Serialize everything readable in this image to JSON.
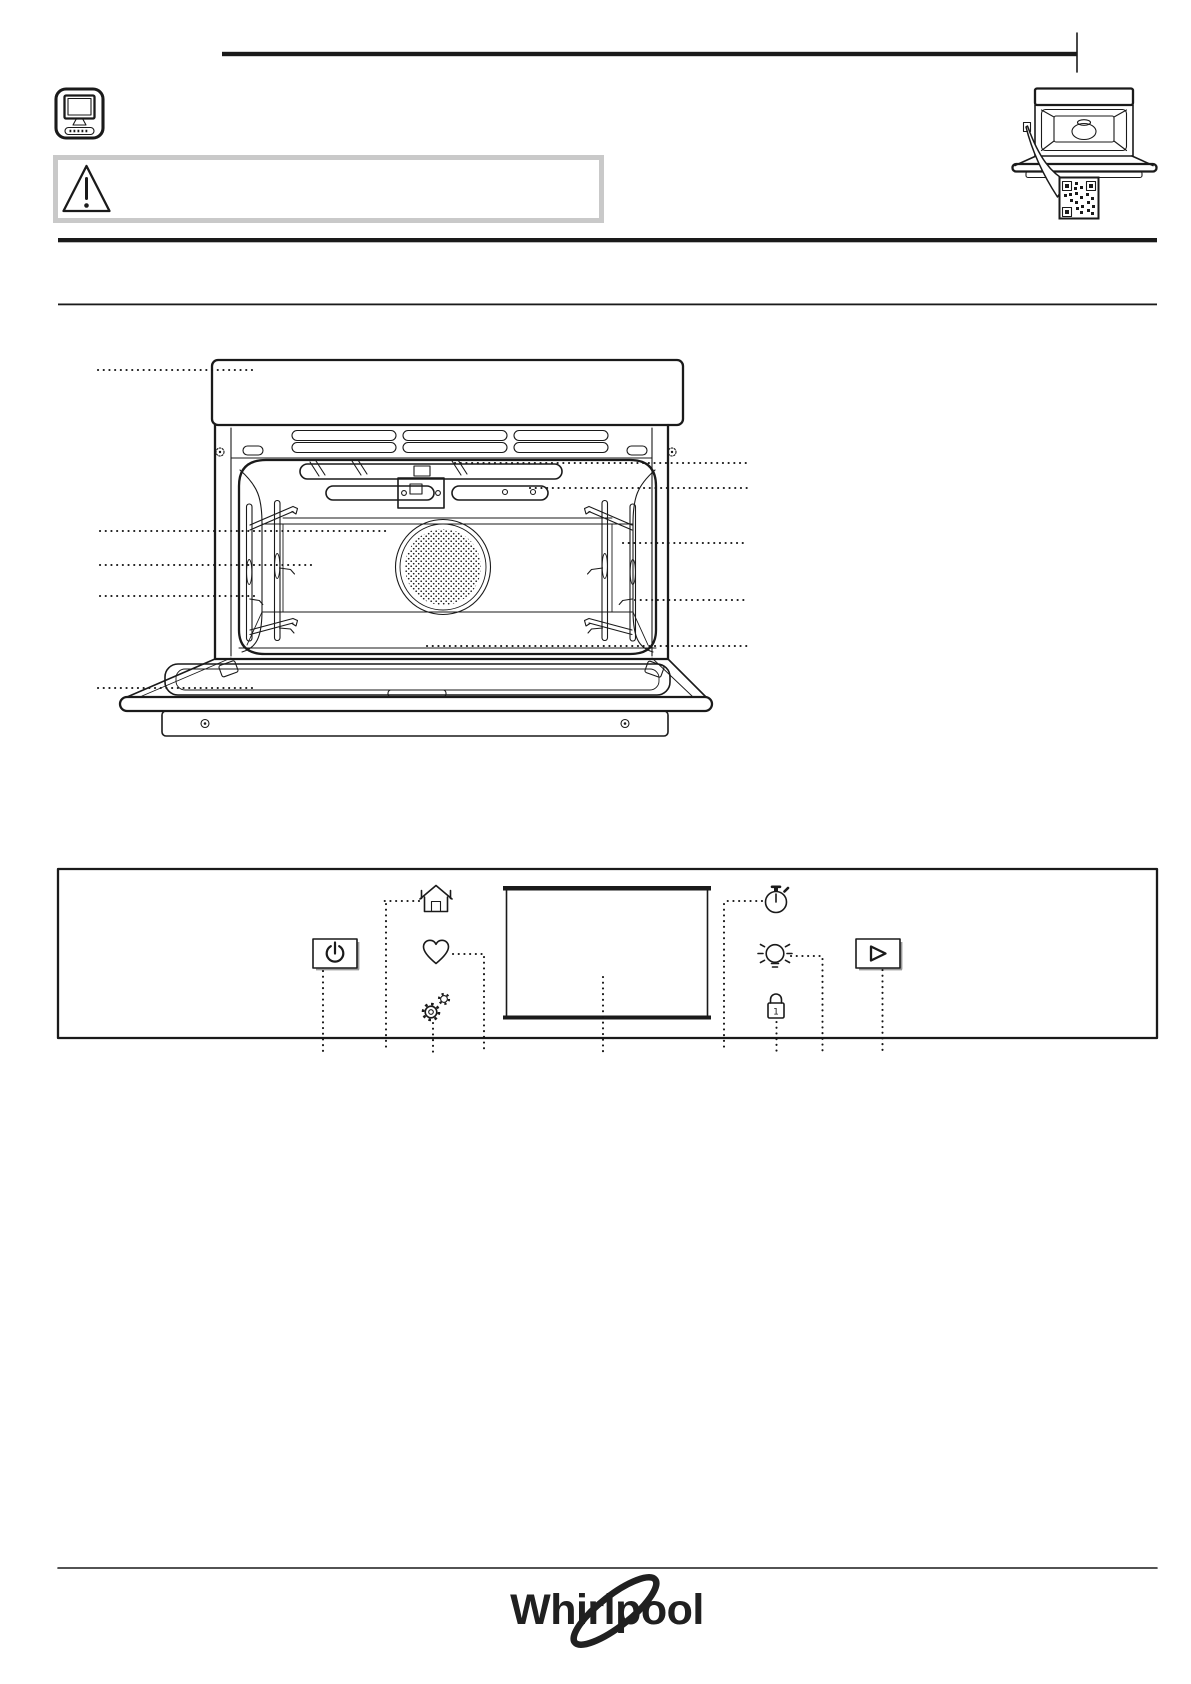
{
  "page": {
    "background": "#ffffff",
    "ink": "#1a1a1a",
    "width": 1191,
    "height": 1684
  },
  "header": {
    "monitor_icon": "computer-monitor-icon",
    "warning_box": {
      "icon": "warning-triangle-icon",
      "border_color": "#c9c9c9",
      "text": ""
    },
    "online_guide": {
      "icon": "oven-page-curl-icon",
      "qr_icon": "qr-code"
    }
  },
  "oven_diagram": {
    "label": "oven-front-view",
    "callouts": {
      "left": 5,
      "right": 5
    },
    "features": [
      "control-panel-band",
      "ventilation-slots",
      "grill-element",
      "shelf-rack-left",
      "shelf-rack-right",
      "fan-cover",
      "cavity",
      "open-door",
      "door-glass",
      "base-plinth"
    ]
  },
  "control_panel": {
    "display": {
      "text": ""
    },
    "lock_digit": "1",
    "buttons": [
      {
        "id": "power",
        "icon": "power-icon"
      },
      {
        "id": "home",
        "icon": "home-icon"
      },
      {
        "id": "favorite",
        "icon": "heart-icon"
      },
      {
        "id": "settings",
        "icon": "gears-icon"
      },
      {
        "id": "timer",
        "icon": "timer-icon"
      },
      {
        "id": "light",
        "icon": "light-bulb-icon"
      },
      {
        "id": "key-lock",
        "icon": "lock-icon"
      },
      {
        "id": "start",
        "icon": "play-icon"
      }
    ]
  },
  "footer": {
    "brand": "Whirlpool"
  }
}
